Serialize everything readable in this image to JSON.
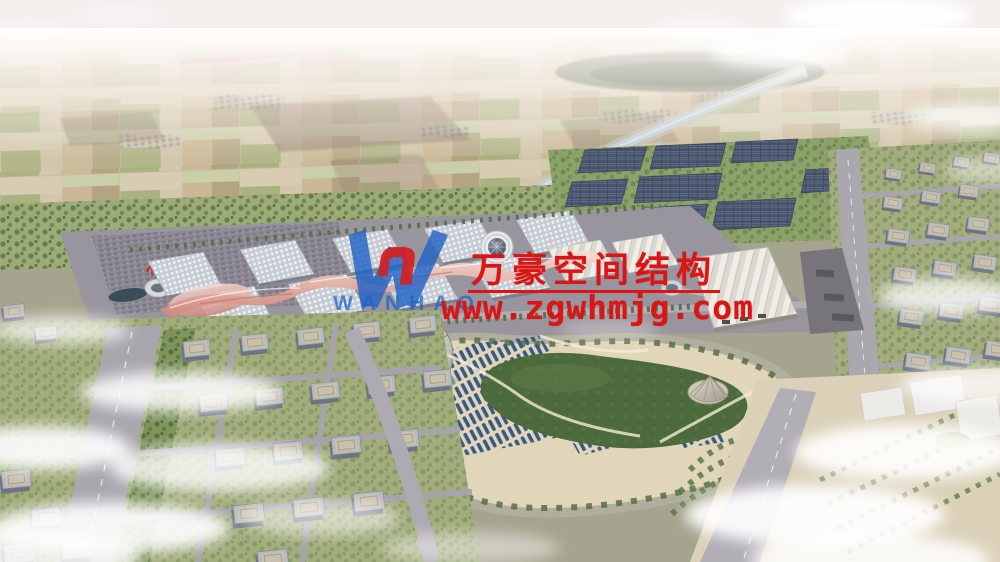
{
  "watermark": {
    "company_name_cn": "万豪空间结构",
    "website_url": "www.zgwhmjg.com",
    "logo_text": "WANHAO",
    "logo_mark": "W",
    "text_color": "#dd1414",
    "logo_blue": "#2263c6",
    "logo_red": "#d62020"
  },
  "palette": {
    "haze_white": "#f3efec",
    "farmland_tan": "#d8cdb3",
    "field_green": "#a6b07c",
    "tree_green": "#4d6a3e",
    "canal_water": "#c2ced4",
    "expo_roof_grey": "#c6cbd2",
    "canopy_pink": "#d28c82",
    "road_grey": "#a7a3ab",
    "solar_panel_navy": "#46536b",
    "park_sand": "#e1d6ba",
    "stall_blue": "#3a5a84",
    "building_roof_beige": "#c9c0ad",
    "cloud_white": "#ffffff"
  }
}
